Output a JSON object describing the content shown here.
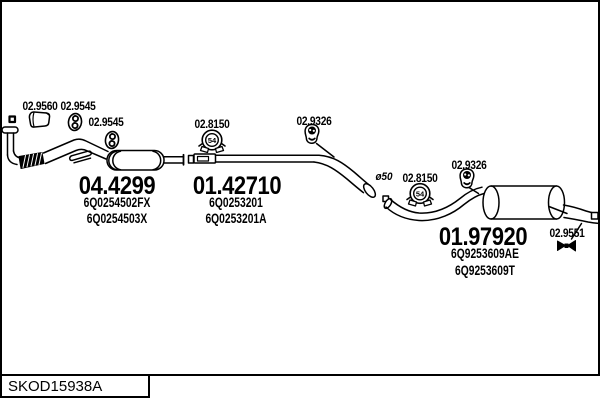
{
  "diagram": {
    "bottom_code": "SKOD15938A",
    "clamp_size": "54",
    "pipe_diameter_label": "ø50",
    "colors": {
      "line": "#000000",
      "background": "#ffffff"
    },
    "sections": [
      {
        "part_number": "04.4299",
        "oem_refs": [
          "6Q0254502FX",
          "6Q0254503X"
        ]
      },
      {
        "part_number": "01.42710",
        "oem_refs": [
          "6Q0253201",
          "6Q0253201A"
        ]
      },
      {
        "part_number": "01.97920",
        "oem_refs": [
          "6Q9253609AE",
          "6Q9253609T"
        ]
      }
    ],
    "fittings": [
      {
        "label": "02.9560"
      },
      {
        "label": "02.9545"
      },
      {
        "label": "02.9545"
      },
      {
        "label": "02.8150"
      },
      {
        "label": "02.9326"
      },
      {
        "label": "02.8150"
      },
      {
        "label": "02.9326"
      },
      {
        "label": "02.9551"
      }
    ]
  }
}
